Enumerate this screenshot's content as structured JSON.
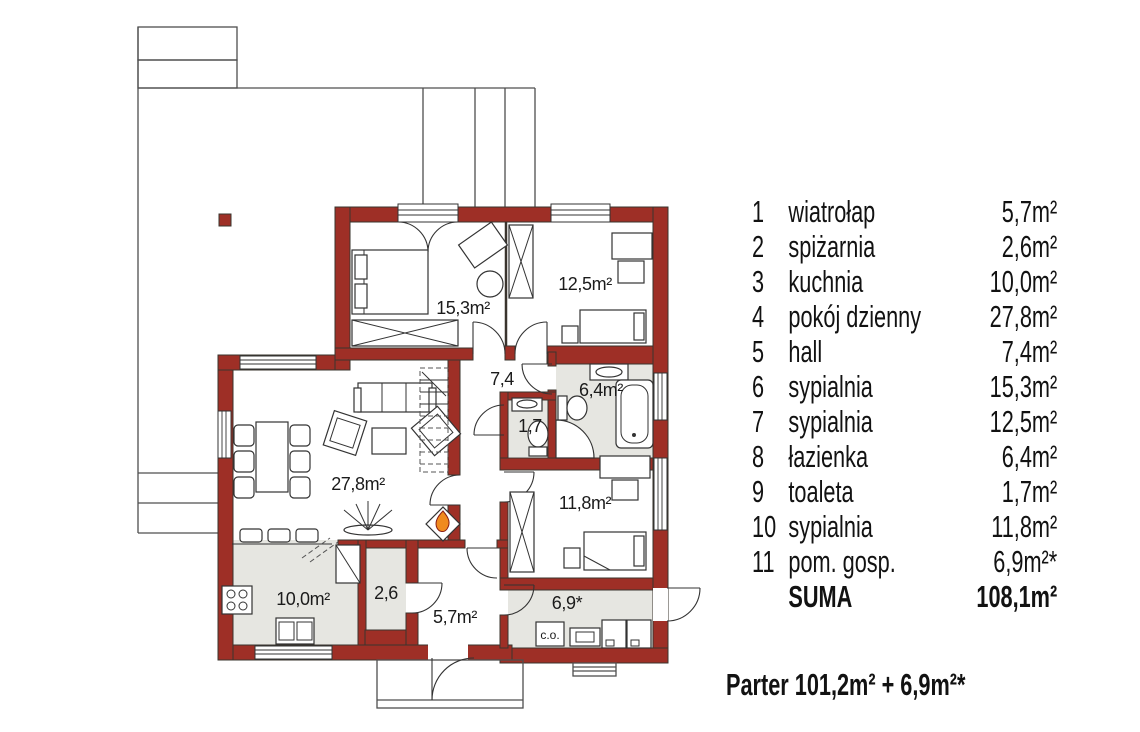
{
  "plan": {
    "room_labels": [
      {
        "room": "sypialnia-6",
        "label": "15,3m²"
      },
      {
        "room": "sypialnia-7",
        "label": "12,5m²"
      },
      {
        "room": "hall",
        "label": "7,4"
      },
      {
        "room": "lazienka",
        "label": "6,4m²"
      },
      {
        "room": "toaleta",
        "label": "1,7"
      },
      {
        "room": "pokoj-dzienny",
        "label": "27,8m²"
      },
      {
        "room": "sypialnia-10",
        "label": "11,8m²"
      },
      {
        "room": "kuchnia",
        "label": "10,0m²"
      },
      {
        "room": "spizarnia",
        "label": "2,6"
      },
      {
        "room": "wiatrolap",
        "label": "5,7m²"
      },
      {
        "room": "pom-gosp",
        "label": "6,9*"
      },
      {
        "room": "kociol-co",
        "label": "c.o."
      }
    ]
  },
  "legend": {
    "items": [
      {
        "num": "1",
        "name": "wiatrołap",
        "area": "5,7m²"
      },
      {
        "num": "2",
        "name": "spiżarnia",
        "area": "2,6m²"
      },
      {
        "num": "3",
        "name": "kuchnia",
        "area": "10,0m²"
      },
      {
        "num": "4",
        "name": "pokój dzienny",
        "area": "27,8m²"
      },
      {
        "num": "5",
        "name": "hall",
        "area": "7,4m²"
      },
      {
        "num": "6",
        "name": "sypialnia",
        "area": "15,3m²"
      },
      {
        "num": "7",
        "name": "sypialnia",
        "area": "12,5m²"
      },
      {
        "num": "8",
        "name": "łazienka",
        "area": "6,4m²"
      },
      {
        "num": "9",
        "name": "toaleta",
        "area": "1,7m²"
      },
      {
        "num": "10",
        "name": "sypialnia",
        "area": "11,8m²"
      },
      {
        "num": "11",
        "name": "pom. gosp.",
        "area": "6,9m²*"
      }
    ],
    "suma_label": "SUMA",
    "suma_value": "108,1m²"
  },
  "footer": {
    "text": "Parter  101,2m² + 6,9m²*"
  },
  "colors": {
    "wall": "#9e2f26",
    "floor": "#e6e6e1",
    "flame": "#f08a1e"
  }
}
